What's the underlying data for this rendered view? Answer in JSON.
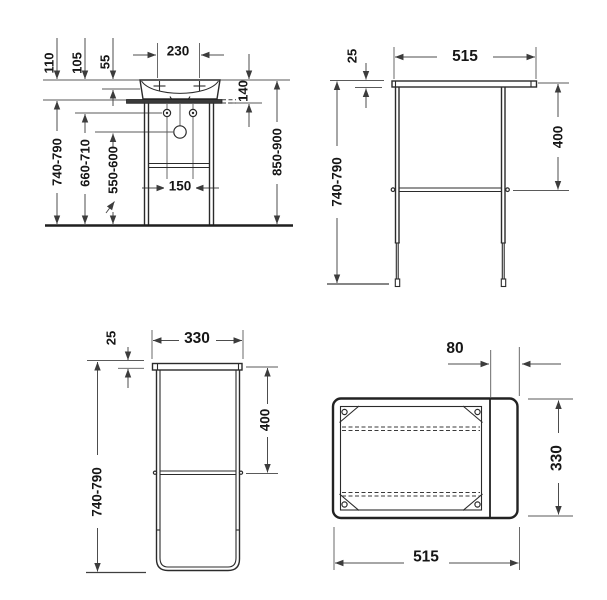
{
  "drawing": {
    "product": "washbasin-console-technical-drawing",
    "line_color": "#2b2b2b",
    "dim_color": "#4d4d4d",
    "views": {
      "washbasin_front": {
        "title": "washbasin with console front view",
        "labels": {
          "tap_spacing": "230",
          "rim_to_frame": "110",
          "rim_to_fixing": "105",
          "rim_to_inner_edge": "55",
          "basin_with_console_height": "140",
          "frame_height": "740-790",
          "fixing_height": "660-710",
          "drain_height": "550-600",
          "rim_height": "850-900",
          "fixing_spacing": "150"
        }
      },
      "frame_front": {
        "title": "console frame front view",
        "labels": {
          "bar_thickness": "25",
          "width": "515",
          "crossbar_drop": "400",
          "height": "740-790"
        }
      },
      "frame_side": {
        "title": "console frame side view",
        "labels": {
          "bar_thickness": "25",
          "depth": "330",
          "crossbar_drop": "400",
          "height": "740-790"
        }
      },
      "frame_top": {
        "title": "console frame top view",
        "labels": {
          "towel_rail_section": "80",
          "depth": "330",
          "width": "515"
        }
      }
    }
  }
}
